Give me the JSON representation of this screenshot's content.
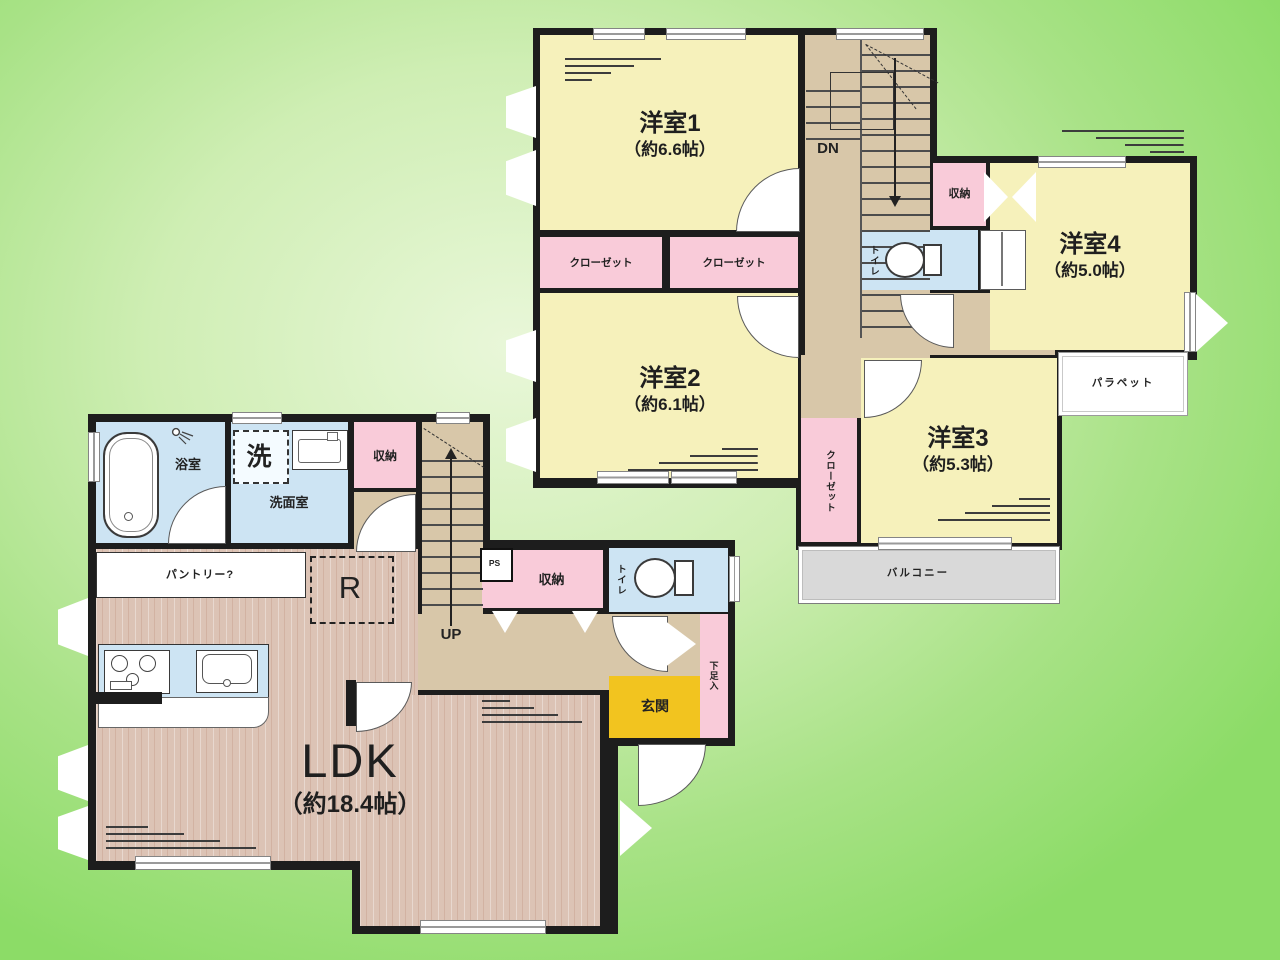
{
  "floor2": {
    "room1_name": "洋室1",
    "room1_size": "（約6.6帖）",
    "room2_name": "洋室2",
    "room2_size": "（約6.1帖）",
    "room3_name": "洋室3",
    "room3_size": "（約5.3帖）",
    "room4_name": "洋室4",
    "room4_size": "（約5.0帖）",
    "closet_a": "クローゼット",
    "closet_b": "クローゼット",
    "closet_c": "クローゼット",
    "storage": "収納",
    "toilet": "トイレ",
    "stairs_down": "DN",
    "balcony": "バルコニー",
    "parapet": "パラペット"
  },
  "floor1": {
    "ldk_name": "LDK",
    "ldk_size": "（約18.4帖）",
    "bath": "浴室",
    "laundry": "洗",
    "washroom": "洗面室",
    "storage_top": "収納",
    "pantry": "パントリー?",
    "fridge": "R",
    "stairs_up": "UP",
    "pipe_space": "PS",
    "storage_hall": "収納",
    "toilet": "トイレ",
    "shoe_cabinet": "下足入",
    "entrance": "玄関"
  },
  "colors": {
    "background_green": "#8cdc67",
    "room_yellow": "#f6f1bb",
    "closet_pink": "#f9cbd9",
    "water_blue": "#cde4f3",
    "hall_tan": "#d8c7a9",
    "wood_floor": "#dcc3b5",
    "entrance_yellow": "#f2c41f",
    "balcony_gray": "#d9d9d9",
    "wall_black": "#1d1d1d"
  }
}
